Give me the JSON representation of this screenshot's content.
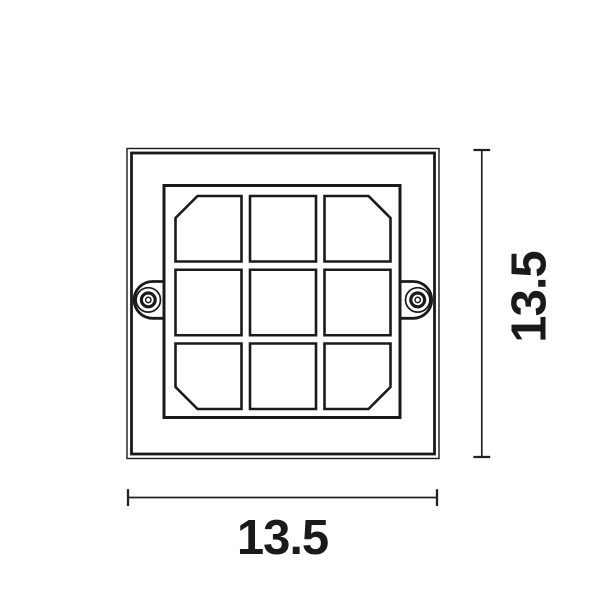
{
  "colors": {
    "background": "#ffffff",
    "line": "#1a1a1a",
    "dimension_line": "#222222"
  },
  "drawing": {
    "description": "Front-view technical line drawing of a square fixture: double-line outer frame, inner square louver frame holding a 3x3 grid of cells (corner cells chamfered on their outer corners), and left/right mounting ears with concentric screw heads",
    "grid": {
      "rows": 3,
      "columns": 3
    },
    "dimensions": {
      "width_label": "13.5",
      "height_label": "13.5"
    }
  }
}
